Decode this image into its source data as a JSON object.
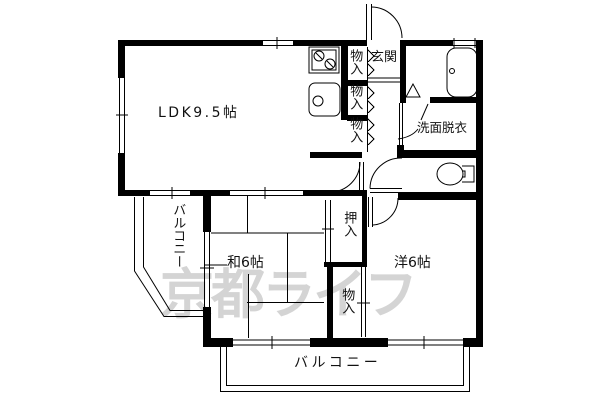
{
  "plan": {
    "title_hint": "apartment floor plan",
    "rooms": {
      "ldk_label": "LDK9.5帖",
      "genkan_label": "玄関",
      "washitsu_label": "和6帖",
      "youshitsu_label": "洋6帖",
      "washroom_label": "洗面脱衣",
      "balcony_left_label": "バルコニー",
      "balcony_bottom_label": "バルコニー",
      "oshiire_label": "押入",
      "storage1_label": "物入",
      "storage2_label": "物入",
      "storage3_label": "物入",
      "storage4_label": "物入"
    },
    "fixtures": [
      "stove",
      "kitchen-sink",
      "bathtub",
      "toilet"
    ],
    "watermark": "京都ライフ",
    "colors": {
      "line": "#000000",
      "background": "#ffffff",
      "watermark": "#d4d4d4"
    }
  }
}
